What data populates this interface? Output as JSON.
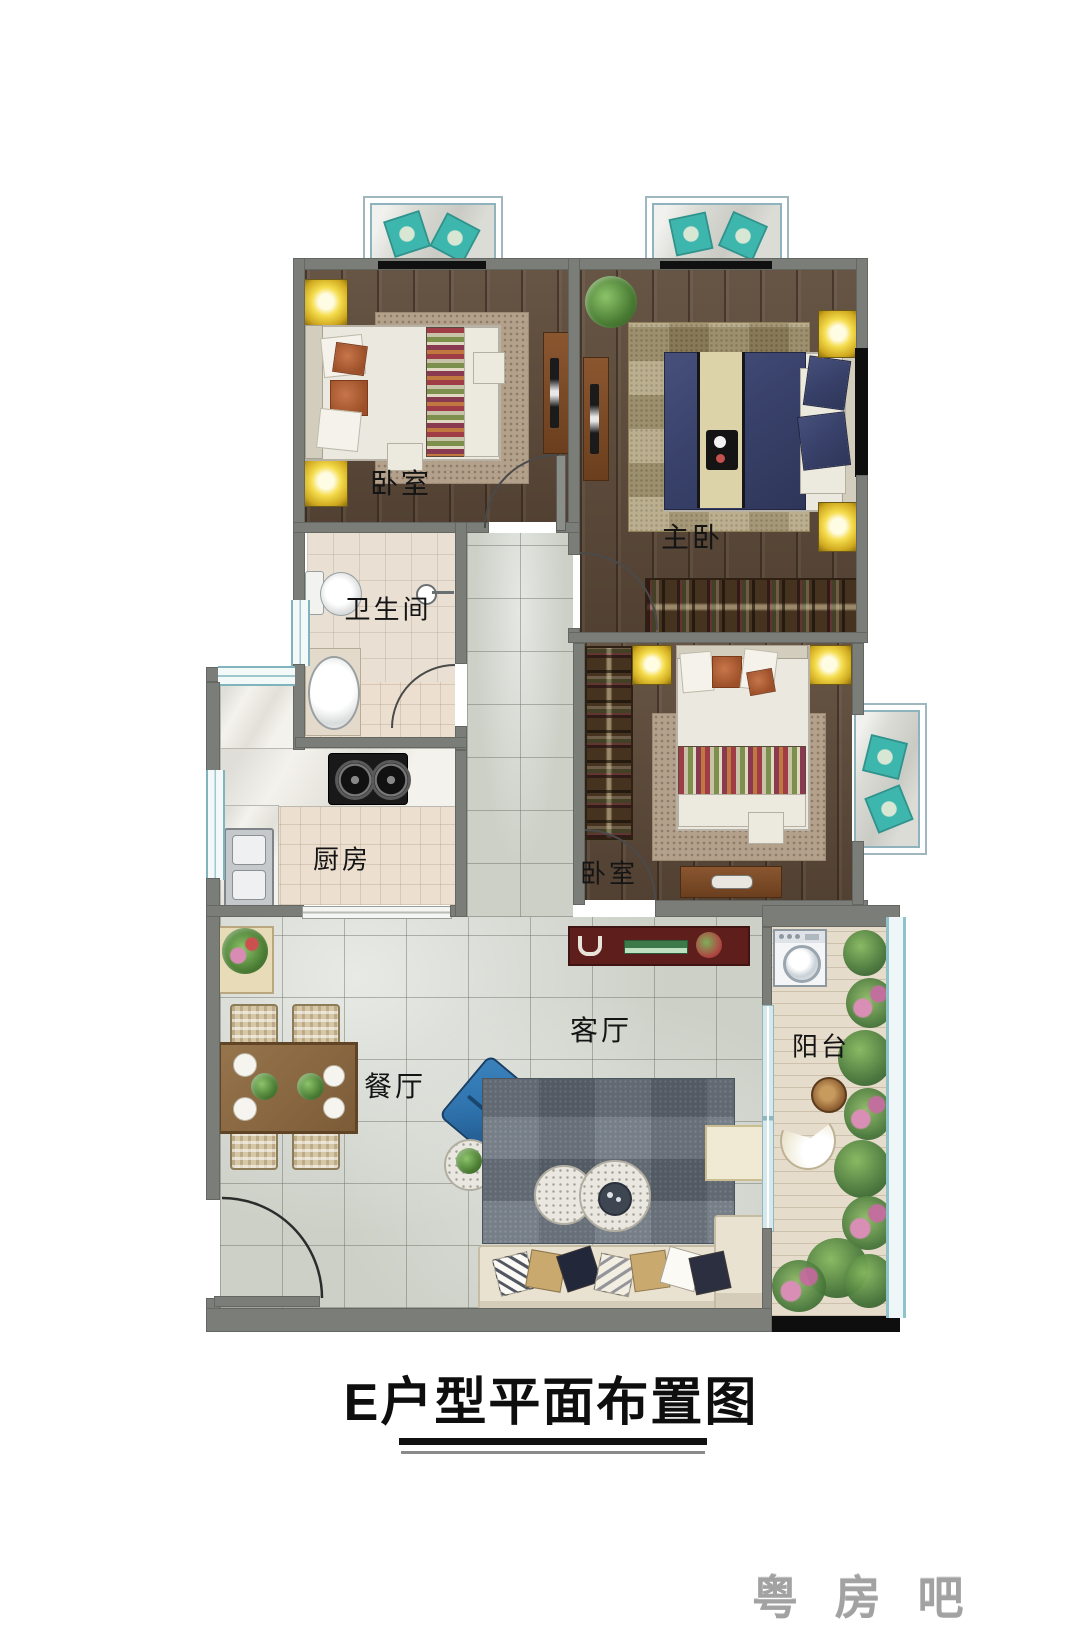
{
  "title": {
    "text": "E户型平面布置图"
  },
  "watermark": {
    "text": "粤 房 吧"
  },
  "rooms": {
    "bedroom1": {
      "label": "卧室"
    },
    "master_bedroom": {
      "label": "主卧"
    },
    "bathroom": {
      "label": "卫生间"
    },
    "kitchen": {
      "label": "厨房"
    },
    "bedroom2": {
      "label": "卧室"
    },
    "living_room": {
      "label": "客厅"
    },
    "dining_room": {
      "label": "餐厅"
    },
    "balcony": {
      "label": "阳台"
    }
  },
  "colors": {
    "wall_gray": "#7b7e78",
    "wood_floor": "#5d4a39",
    "marble_floor": "#ccd0c7",
    "tile_beige": "#e9dfd3",
    "window_teal": "#7fb3bd",
    "window_black": "#0e0e0e",
    "lamp_yellow": "#f5dd4e",
    "tv_cabinet_red": "#5e1f1c",
    "bed_navy": "#39426b",
    "armchair_blue": "#2f74ae",
    "sofa_cream": "#e9e2d1",
    "rug_gray": "#636c77",
    "plant_green": "#4a7c33",
    "accent_teal_pillow": "#3db6ad"
  }
}
